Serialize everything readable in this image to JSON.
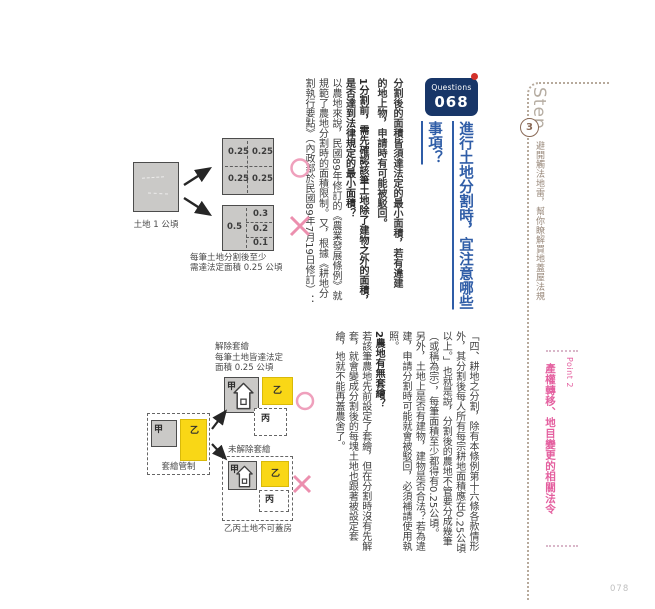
{
  "sidebar": {
    "step_label": "Step",
    "step_number": "3",
    "step_description": "避開觸法地雷，幫你瞭解買地蓋屋法規",
    "point_label": "Point 2",
    "point_title": "產權轉移、地目變更的相關法令",
    "page_number": "078"
  },
  "question": {
    "badge_label": "Questions",
    "badge_number": "068",
    "title_columns": [
      "進行土地分割時，宜注意哪些",
      "事項？"
    ],
    "summary_columns": [
      "分割後的面積皆須達法定的最小面積，若有違建",
      "的地上物，申請時有可能被駁回。"
    ]
  },
  "section1": {
    "heading_columns": [
      "1分割前，需先確認該筆土地除了建物之外的面積，",
      "是否達到法律規定的最小面積？"
    ],
    "body_columns": [
      "以農地來說，民國89年修訂的《農業發展條例》就",
      "規範了農地分割時的面積限制。又，根據《耕地分",
      "割執行要點》（內政部於民國89年7月19日修訂）："
    ],
    "quote_columns": [
      "「四、耕地之分割，除有本條例第十六條各款情形",
      "外，其分割後每人所有每宗耕地面積應在0.25公頃",
      "以上。」也就是說，分割後的農地不管要分成幾筆",
      "（或稱為宗），每筆面積至少都得有0.25公頃。",
      "另外，土地上是否有建物，建物是否合法？若為違",
      "建，申請分割時可能就會被駁回，必須補請使用執",
      "照。"
    ]
  },
  "section2": {
    "heading": "2農地有無套繪？",
    "body_columns": [
      "若該筆農地先前設定了套繪，但在分割時沒有先解",
      "套，就會變成分割後的每塊土地也跟著被設定套",
      "繪，地就不能再蓋農舍了。"
    ]
  },
  "diagram_split": {
    "source_label": "土地 1 公頃",
    "ok_values": [
      "0.25",
      "0.25",
      "0.25",
      "0.25"
    ],
    "ng_left_value": "0.5",
    "ng_right_values": [
      "0.3",
      "0.2",
      "0.1"
    ],
    "caption_line1": "每筆土地分割後至少",
    "caption_line2": "需達法定面積 0.25 公頃"
  },
  "diagram_overlay": {
    "source": {
      "plot_a": "甲",
      "plot_b": "乙",
      "caption": "套繪管制"
    },
    "released": {
      "caption_lines": [
        "解除套繪",
        "每筆土地皆達法定",
        "面積 0.25 公頃"
      ],
      "plot_a": "甲",
      "plot_b": "乙",
      "plot_c": "丙"
    },
    "not_released": {
      "caption": "未解除套繪",
      "plot_a": "甲",
      "plot_b": "乙",
      "plot_c": "丙",
      "footer": "乙丙土地不可蓋房"
    }
  },
  "icons": {
    "ok_mark": "circle-outline",
    "ng_mark": "cross",
    "house": "house-shape"
  },
  "colors": {
    "badge_navy": "#183668",
    "title_blue": "#2f5da7",
    "point_pink": "#e45f9f",
    "mark_pink": "#efa0bc",
    "step_brown": "#99897b",
    "land_gray": "#cac9c7",
    "highlight_yellow": "#f9d716",
    "badge_dot_red": "#d3312a"
  }
}
